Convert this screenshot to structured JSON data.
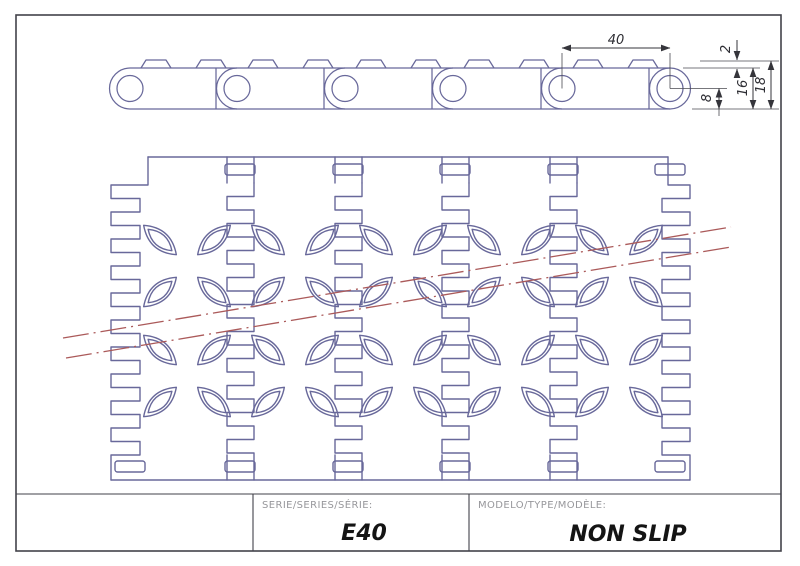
{
  "document": {
    "type_note": "technical drawing of modular conveyor belt"
  },
  "dimensions": {
    "pitch": "40",
    "tab_height": "2",
    "body_height": "16",
    "total_height": "18",
    "hole_to_bottom": "8"
  },
  "title_block": {
    "series_label": "SERIE/SERIES/SÉRIE:",
    "series_value": "E40",
    "model_label": "MODELO/TYPE/MODÈLE:",
    "model_value": "NON SLIP"
  },
  "colors": {
    "outline_blue": "#68689a",
    "centerline_red": "#ab5a5a",
    "dimension": "#35353b",
    "frame": "#42424a",
    "label_gray": "#97979b",
    "background": "#ffffff"
  },
  "side_view": {
    "hole_cx": [
      130,
      237,
      345,
      453,
      562,
      670
    ],
    "hole_cy": 88.5,
    "hole_r": 13,
    "body_top": 68,
    "body_bottom": 109,
    "cap_r": 20.5,
    "tab_top": 60,
    "tab_centers": [
      156,
      211,
      263,
      318,
      371,
      426,
      479,
      534,
      588,
      643
    ]
  },
  "plan_view": {
    "left": 111,
    "right": 690,
    "top": 157,
    "bottom": 480,
    "left_inner": 140,
    "right_inner": 662,
    "top_edge_x1": 148,
    "top_edge_x2": 668,
    "shoulder_y": 185,
    "seam_centers": [
      240,
      348,
      455,
      563
    ],
    "seam_half_left": 13,
    "seam_half_right": 14,
    "wave_top": 183,
    "wave_bottom": 455,
    "wave_step": 13.5,
    "top_slots": [
      240,
      348,
      455,
      563,
      670
    ],
    "bottom_slots": [
      130,
      240,
      348,
      455,
      563,
      670
    ],
    "slot_w": 30,
    "slot_h": 11,
    "top_slot_y": 164,
    "bottom_slot_y": 461,
    "leaf_rows": [
      240,
      292,
      350,
      402
    ],
    "leaf_cols": [
      160,
      214,
      268,
      322,
      376,
      430,
      484,
      538,
      592,
      646
    ],
    "leaf_angle": 42,
    "leaf_outer": {
      "a": 22,
      "q": 17
    },
    "leaf_inner": {
      "a": 16,
      "q": 12
    }
  },
  "centerlines": [
    {
      "x1": 63,
      "y1": 338,
      "x2": 731,
      "y2": 227
    },
    {
      "x1": 66,
      "y1": 358,
      "x2": 731,
      "y2": 247
    }
  ]
}
